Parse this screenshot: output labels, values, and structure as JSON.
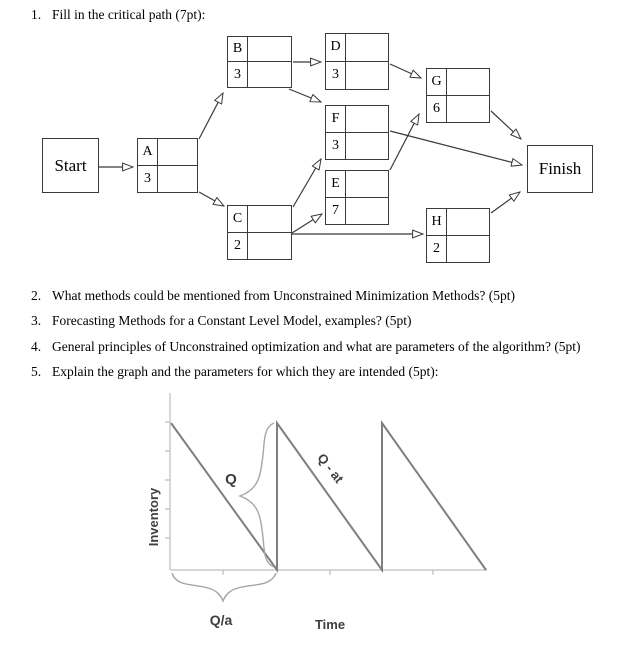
{
  "questions": {
    "q1": {
      "number": "1.",
      "text": "Fill in the critical path (7pt):"
    },
    "items": [
      {
        "number": "2.",
        "text": "What methods could be mentioned from Unconstrained Minimization Methods? (5pt)"
      },
      {
        "number": "3.",
        "text": "Forecasting Methods for a Constant Level Model, examples? (5pt)"
      },
      {
        "number": "4.",
        "text": "General principles of Unconstrained optimization and what are parameters of the algorithm? (5pt)"
      },
      {
        "number": "5.",
        "text": "Explain the graph and the parameters for which they are intended (5pt):"
      }
    ]
  },
  "diagram": {
    "start_label": "Start",
    "finish_label": "Finish",
    "nodes": [
      {
        "id": "A",
        "duration": "3"
      },
      {
        "id": "B",
        "duration": "3"
      },
      {
        "id": "C",
        "duration": "2"
      },
      {
        "id": "D",
        "duration": "3"
      },
      {
        "id": "F",
        "duration": "3"
      },
      {
        "id": "E",
        "duration": "7"
      },
      {
        "id": "G",
        "duration": "6"
      },
      {
        "id": "H",
        "duration": "2"
      }
    ],
    "edges": [
      "Start→A",
      "A→B",
      "A→C",
      "B→D",
      "B→F",
      "C→F",
      "C→E",
      "C→H",
      "D→G",
      "E→G",
      "F→Finish",
      "G→Finish",
      "H→Finish"
    ]
  },
  "chart_data": {
    "type": "line",
    "title": "EOQ sawtooth inventory pattern",
    "xlabel": "Time",
    "ylabel": "Inventory",
    "annotations": {
      "jump": "Q",
      "slope": "Q - at",
      "cycle": "Q/a"
    },
    "series": [
      {
        "name": "inventory level",
        "x": [
          0,
          "Q/a",
          "Q/a",
          "2Q/a",
          "2Q/a",
          "3Q/a"
        ],
        "y": [
          "Q",
          0,
          "Q",
          0,
          "Q",
          0
        ]
      }
    ],
    "layout": {
      "grid": false,
      "legend": "none",
      "cycles_shown": 3
    },
    "colors": {
      "line": "#7f7f7f",
      "axis": "#bfbfbf",
      "brace": "#a6a6a6",
      "label": "#3f3f3f"
    }
  }
}
